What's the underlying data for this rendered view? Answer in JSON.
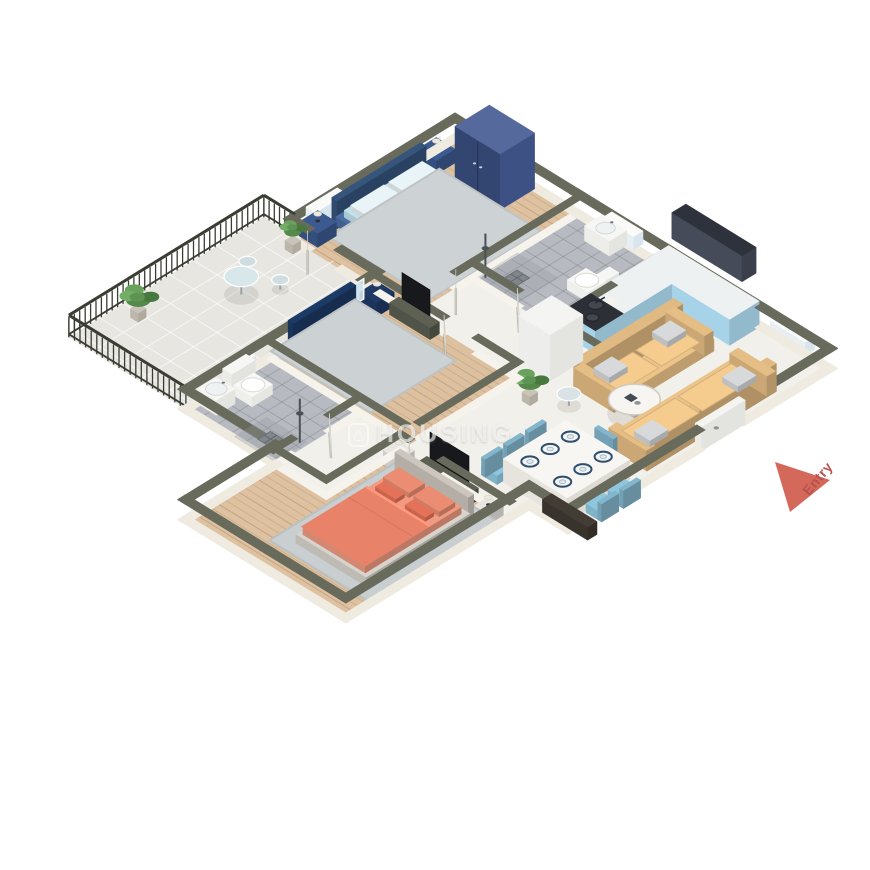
{
  "watermark": {
    "icon": "house-icon",
    "text": "HOUSING"
  },
  "entry_marker": {
    "label": "Entry",
    "arrow_color": "#d4695b",
    "label_color": "#b8524b",
    "triangle": [
      [
        775,
        462
      ],
      [
        830,
        480
      ],
      [
        790,
        512
      ]
    ]
  },
  "palette": {
    "wall_top": "#686b5b",
    "wall_face_ext": "#efebe1",
    "wall_face_int": "#f5f3ec",
    "wood_floor": "#ddc1a0",
    "marble_floor": "#f2f0ea",
    "tile_floor": "#b7bbc1",
    "balcony_floor": "#e7e6e1",
    "sofa": "#ecc489",
    "cushion_gray": "#d7d9da",
    "chair": "#8ec6de",
    "table_white": "#f7f6f3",
    "kitchen_blue": "#a7d3e8",
    "counter_top": "#eef1f2",
    "stove_top": "#2c3036",
    "upper_cabinet": "#2e323c",
    "wardrobe_navy": "#55699c",
    "bed_light_blue": "#a6d6e9",
    "bed_blue": "#2e6cb5",
    "bed_coral": "#e88268",
    "railing_dark": "#3a3d33"
  },
  "scene": {
    "projection": {
      "ox": 455,
      "oy": 138,
      "ax": 0.78,
      "ay": 0.48,
      "bx": -0.78,
      "by": 0.48
    },
    "floors": [
      {
        "id": "balcony-floor",
        "fill": "#e7e6e1",
        "rect": [
          -40,
          205,
          110,
          455
        ],
        "grid": {
          "step": 30,
          "color": "rgba(255,255,255,0.65)"
        }
      },
      {
        "id": "master-bedroom-floor",
        "fill": "#ddc1a0",
        "rect": [
          0,
          0,
          157,
          210
        ],
        "planks": true
      },
      {
        "id": "bathroom1-floor",
        "fill": "#b7bbc1",
        "rect": [
          157,
          0,
          270,
          135
        ],
        "grid": {
          "step": 18,
          "color": "rgba(120,125,132,0.4)"
        }
      },
      {
        "id": "hall-kitchen-dining-floor",
        "fill": "#f2f0ea",
        "poly": [
          [
            270,
            0
          ],
          [
            480,
            0
          ],
          [
            480,
            335
          ],
          [
            430,
            335
          ],
          [
            430,
            360
          ],
          [
            290,
            360
          ],
          [
            290,
            455
          ],
          [
            225,
            455
          ],
          [
            225,
            350
          ],
          [
            290,
            350
          ],
          [
            290,
            210
          ],
          [
            157,
            210
          ],
          [
            157,
            135
          ],
          [
            270,
            135
          ]
        ]
      },
      {
        "id": "bedroom2-floor",
        "fill": "#dcc09f",
        "rect": [
          110,
          210,
          290,
          347
        ],
        "planks": true
      },
      {
        "id": "bathroom2-floor",
        "fill": "#b7bbc1",
        "rect": [
          110,
          350,
          225,
          455
        ],
        "grid": {
          "step": 18,
          "color": "rgba(120,125,132,0.4)"
        }
      },
      {
        "id": "bedroom3-floor",
        "fill": "#ddc1a0",
        "poly": [
          [
            290,
            360
          ],
          [
            430,
            360
          ],
          [
            430,
            570
          ],
          [
            225,
            570
          ],
          [
            225,
            455
          ],
          [
            290,
            455
          ]
        ],
        "planks": [
          [
            292,
            362,
            428,
            453
          ],
          [
            227,
            457,
            428,
            568
          ]
        ]
      }
    ],
    "walls": {
      "ext": {
        "t": 11,
        "h": 20,
        "top": "#686b5b",
        "face": "#efebe1"
      },
      "int": {
        "t": 9,
        "h": 16,
        "top": "#686b5b",
        "face": "#f5f3ec"
      },
      "segs": [
        [
          "e",
          0,
          0,
          157,
          0
        ],
        [
          "e",
          157,
          0,
          270,
          0
        ],
        [
          "e",
          270,
          0,
          395,
          0
        ],
        [
          "e",
          395,
          0,
          480,
          0
        ],
        [
          "e",
          480,
          0,
          480,
          110
        ],
        [
          "e",
          480,
          170,
          480,
          335
        ],
        [
          "e",
          430,
          335,
          480,
          335
        ],
        [
          "e",
          430,
          335,
          430,
          460
        ],
        [
          "e",
          430,
          460,
          430,
          570
        ],
        [
          "e",
          330,
          570,
          430,
          570
        ],
        [
          "e",
          225,
          570,
          330,
          570
        ],
        [
          "e",
          225,
          455,
          225,
          570
        ],
        [
          "e",
          110,
          455,
          225,
          455
        ],
        [
          "e",
          110,
          360,
          110,
          455
        ],
        [
          "e",
          110,
          288,
          110,
          360
        ],
        [
          "e",
          110,
          210,
          110,
          227
        ],
        [
          "e",
          65,
          210,
          110,
          210
        ],
        [
          "e",
          0,
          210,
          20,
          210
        ],
        [
          "e",
          0,
          110,
          0,
          210
        ],
        [
          "e",
          0,
          0,
          0,
          110
        ],
        [
          "i",
          157,
          0,
          157,
          80
        ],
        [
          "i",
          157,
          80,
          157,
          155
        ],
        [
          "i",
          157,
          200,
          157,
          214
        ],
        [
          "i",
          157,
          135,
          215,
          135
        ],
        [
          "i",
          255,
          135,
          274,
          135
        ],
        [
          "i",
          270,
          0,
          270,
          70
        ],
        [
          "i",
          270,
          70,
          270,
          140
        ],
        [
          "i",
          270,
          140,
          334,
          140
        ],
        [
          "i",
          114,
          210,
          195,
          210
        ],
        [
          "i",
          240,
          210,
          290,
          210
        ],
        [
          "i",
          290,
          210,
          290,
          335
        ],
        [
          "i",
          114,
          347,
          282,
          347
        ],
        [
          "i",
          225,
          350,
          225,
          385
        ],
        [
          "i",
          225,
          435,
          225,
          458
        ],
        [
          "i",
          225,
          455,
          290,
          455
        ],
        [
          "i",
          290,
          360,
          290,
          455
        ],
        [
          "i",
          290,
          360,
          300,
          360
        ],
        [
          "i",
          345,
          360,
          430,
          360
        ]
      ]
    },
    "windows": [
      {
        "id": "window-master-1",
        "r": [
          -6,
          25,
          6,
          65
        ]
      },
      {
        "id": "window-master-2",
        "r": [
          -6,
          145,
          6,
          185
        ]
      },
      {
        "id": "window-bathroom1",
        "r": [
          195,
          -6,
          235,
          6
        ]
      },
      {
        "id": "window-living",
        "r": [
          410,
          -6,
          455,
          6
        ]
      },
      {
        "id": "window-bathroom2",
        "r": [
          104,
          372,
          116,
          402
        ]
      }
    ],
    "doors": {
      "leaves": [
        {
          "id": "door-master-bedroom",
          "s": [
            157,
            156,
            185,
            184
          ]
        },
        {
          "id": "door-balcony",
          "s": [
            22,
            211,
            48,
            237
          ]
        },
        {
          "id": "door-bathroom1",
          "s": [
            216,
            136,
            244,
            162
          ]
        },
        {
          "id": "door-bedroom2",
          "s": [
            197,
            211,
            225,
            237
          ]
        },
        {
          "id": "door-bathroom2",
          "s": [
            226,
            387,
            254,
            413
          ]
        },
        {
          "id": "door-bedroom3",
          "s": [
            302,
            361,
            330,
            387
          ]
        }
      ],
      "entry": {
        "id": "entry-door",
        "r": [
          476,
          112,
          484,
          168
        ]
      },
      "sliding": {
        "id": "sliding-door-balcony",
        "x": 110,
        "y1": 227,
        "y2": 288
      }
    },
    "railing": {
      "color": "#3a3d33",
      "h": 22,
      "segs": [
        [
          -40,
          205,
          0,
          205
        ],
        [
          -40,
          205,
          -40,
          455
        ],
        [
          -40,
          455,
          110,
          455
        ]
      ]
    },
    "furniture": [
      {
        "t": "rug",
        "id": "rug-master",
        "r": [
          22,
          42,
          152,
          184
        ],
        "c": "#cdd2d4"
      },
      {
        "t": "bed",
        "id": "bed-master",
        "r": [
          12,
          56,
          132,
          170
        ],
        "head": "W",
        "frame": "#4a6da3",
        "hb": "#36557c",
        "duvet": "#a6d6e9",
        "sheet": "#c2e2ee",
        "pillow": "#e9f4f8",
        "cushion": "#7fb8d4"
      },
      {
        "t": "nightstand",
        "id": "nightstand-master-1",
        "r": [
          2,
          26,
          26,
          50
        ],
        "c": "#3b5a8f"
      },
      {
        "t": "nightstand",
        "id": "nightstand-master-2",
        "r": [
          2,
          178,
          26,
          202
        ],
        "c": "#3b5a8f"
      },
      {
        "t": "wardrobe",
        "id": "wardrobe-master",
        "r": [
          46,
          2,
          104,
          46
        ],
        "h": 56,
        "top": "#55699c",
        "fx": "#3d5184",
        "fy": "#334672"
      },
      {
        "t": "rug",
        "id": "rug-bedroom2",
        "r": [
          104,
          232,
          232,
          340
        ],
        "c": "#ccd1d3"
      },
      {
        "t": "bed",
        "id": "bed-bedroom2",
        "r": [
          112,
          246,
          212,
          326
        ],
        "head": "W",
        "frame": "#2a4d85",
        "hb": "#1c3a66",
        "duvet": "#2e6cb5",
        "sheet": "#4a86c9",
        "pillow": "#dde6ef",
        "cushion": "#1d3a69"
      },
      {
        "t": "nightstand",
        "id": "nightstand-bedroom2",
        "r": [
          114,
          214,
          136,
          236
        ],
        "c": "#203a66"
      },
      {
        "t": "tvunit",
        "id": "tv-bedroom2",
        "console": [
          142,
          214,
          194,
          226
        ],
        "panel": [
          150,
          218,
          186,
          218
        ]
      },
      {
        "t": "rug",
        "id": "rug-bedroom3",
        "r": [
          300,
          372,
          428,
          538
        ],
        "c": "#c9ced0"
      },
      {
        "t": "bed",
        "id": "bed-bedroom3",
        "r": [
          318,
          388,
          412,
          524
        ],
        "head": "N",
        "frame": "#d8d3cc",
        "hb": "#ccc6be",
        "duvet": "#e88268",
        "sheet": "#f09a81",
        "pillow": "#eb8d72",
        "cushion": "#e37258"
      },
      {
        "t": "nightstand",
        "id": "nightstand-bedroom3-1",
        "r": [
          294,
          366,
          314,
          386
        ],
        "c": "#e9e6e1"
      },
      {
        "t": "nightstand",
        "id": "nightstand-bedroom3-2",
        "r": [
          410,
          366,
          428,
          386
        ],
        "c": "#e9e6e1"
      },
      {
        "t": "tvunit",
        "id": "tv-bedroom3",
        "console": [
          326,
          362,
          392,
          374
        ],
        "panel": [
          334,
          366,
          384,
          366
        ]
      },
      {
        "t": "toilet",
        "id": "toilet-bathroom1",
        "tank": [
          256,
          58,
          268,
          90
        ],
        "bowl": [
          230,
          62,
          256,
          86
        ]
      },
      {
        "t": "basin",
        "id": "basin-bathroom1",
        "r": [
          190,
          2,
          222,
          24
        ]
      },
      {
        "t": "shower",
        "id": "shower-bathroom1",
        "r": [
          160,
          80,
          212,
          133
        ],
        "pole": [
          165,
          126
        ]
      },
      {
        "t": "toilet",
        "id": "toilet-bathroom2",
        "tank": [
          114,
          382,
          126,
          412
        ],
        "bowl": [
          126,
          384,
          150,
          410
        ]
      },
      {
        "t": "basin",
        "id": "basin-bathroom2",
        "r": [
          112,
          418,
          136,
          442
        ]
      },
      {
        "t": "shower",
        "id": "shower-bathroom2",
        "r": [
          170,
          412,
          222,
          453
        ],
        "pole": [
          218,
          417
        ]
      },
      {
        "t": "counter",
        "id": "kitchen-counter-north",
        "r": [
          276,
          2,
          392,
          40
        ]
      },
      {
        "t": "counter",
        "id": "kitchen-counter-west",
        "r": [
          276,
          40,
          318,
          104
        ]
      },
      {
        "t": "stove",
        "id": "kitchen-stove",
        "r": [
          276,
          102,
          318,
          138
        ]
      },
      {
        "t": "uppercab",
        "id": "kitchen-upper-cabinet",
        "r": [
          298,
          2,
          388,
          20
        ]
      },
      {
        "t": "fridge",
        "id": "kitchen-tall-unit",
        "r": [
          274,
          150,
          314,
          192
        ]
      },
      {
        "t": "sofa",
        "id": "sofa-1",
        "r": [
          336,
          56,
          388,
          184
        ],
        "back": "W"
      },
      {
        "t": "sofa",
        "id": "sofa-2",
        "r": [
          420,
          58,
          470,
          224
        ],
        "back": "E"
      },
      {
        "t": "coffeetable",
        "id": "coffee-table",
        "c": [
          402,
          172
        ],
        "r": 24
      },
      {
        "t": "roundtable",
        "id": "side-table",
        "c": [
          352,
          206
        ],
        "r": 11,
        "h": 12,
        "top": "#d9e3e5"
      },
      {
        "t": "plant",
        "id": "plant-living",
        "c": [
          322,
          226
        ],
        "r": 12
      },
      {
        "t": "table",
        "id": "dining-table",
        "r": [
          390,
          248,
          472,
          328
        ],
        "plates": true
      },
      {
        "t": "chair",
        "id": "dining-chair-1",
        "r": [
          368,
          256,
          388,
          278
        ],
        "back": "W"
      },
      {
        "t": "chair",
        "id": "dining-chair-2",
        "r": [
          368,
          284,
          388,
          306
        ],
        "back": "W"
      },
      {
        "t": "chair",
        "id": "dining-chair-3",
        "r": [
          368,
          312,
          388,
          334
        ],
        "back": "W"
      },
      {
        "t": "chair",
        "id": "dining-chair-4",
        "r": [
          474,
          256,
          494,
          278
        ],
        "back": "E"
      },
      {
        "t": "chair",
        "id": "dining-chair-5",
        "r": [
          474,
          284,
          494,
          306
        ],
        "back": "E"
      },
      {
        "t": "chair",
        "id": "dining-chair-6",
        "r": [
          410,
          226,
          434,
          246
        ],
        "back": "N"
      },
      {
        "t": "lowcab",
        "id": "shoe-cabinet",
        "r": [
          446,
          322,
          504,
          334
        ],
        "h": 13,
        "top": "#423c35",
        "fx": "#322d27",
        "fy": "#38332c"
      },
      {
        "t": "roundtable",
        "id": "balcony-table",
        "c": [
          26,
          300
        ],
        "r": 16,
        "h": 18,
        "top": "#d8e7ea"
      },
      {
        "t": "roundtable",
        "id": "balcony-stool-1",
        "c": [
          6,
          272
        ],
        "r": 8,
        "h": 10,
        "top": "#cfdde2"
      },
      {
        "t": "roundtable",
        "id": "balcony-stool-2",
        "c": [
          46,
          270
        ],
        "r": 8,
        "h": 10,
        "top": "#cfdde2"
      },
      {
        "t": "plant",
        "id": "balcony-plant-1",
        "c": [
          -16,
          390
        ],
        "r": 13
      },
      {
        "t": "plant",
        "id": "balcony-plant-2",
        "c": [
          12,
          220
        ],
        "r": 9
      }
    ]
  }
}
